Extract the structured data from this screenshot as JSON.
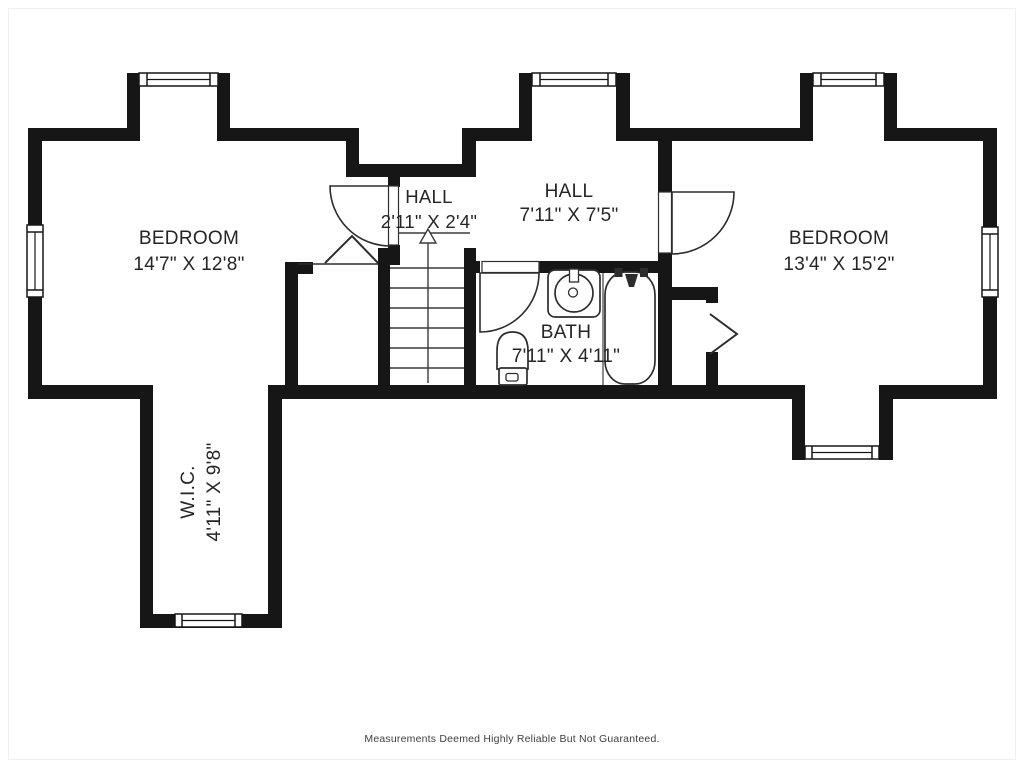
{
  "rooms": [
    {
      "key": "bedroom_left",
      "name": "BEDROOM",
      "dims": "14'7\" X 12'8\""
    },
    {
      "key": "hall_small",
      "name": "HALL",
      "dims": "2'11\" X 2'4\""
    },
    {
      "key": "hall_main",
      "name": "HALL",
      "dims": "7'11\" X 7'5\""
    },
    {
      "key": "bath",
      "name": "BATH",
      "dims": "7'11\" X 4'11\""
    },
    {
      "key": "bedroom_right",
      "name": "BEDROOM",
      "dims": "13'4\" X 15'2\""
    },
    {
      "key": "wic",
      "name": "W.I.C.",
      "dims": "4'11\" X 9'8\""
    }
  ],
  "footer": {
    "disclaimer": "Measurements Deemed Highly Reliable But Not Guaranteed."
  },
  "symbols": {
    "stairs_direction": "up-arrow",
    "closet_door_left": "bifold",
    "closet_door_right": "bifold"
  },
  "colors": {
    "wall": "#161616",
    "fixture_line": "#2d2d2d",
    "label_text": "#252525",
    "footer_text": "#3f3f3f",
    "background": "#ffffff"
  }
}
